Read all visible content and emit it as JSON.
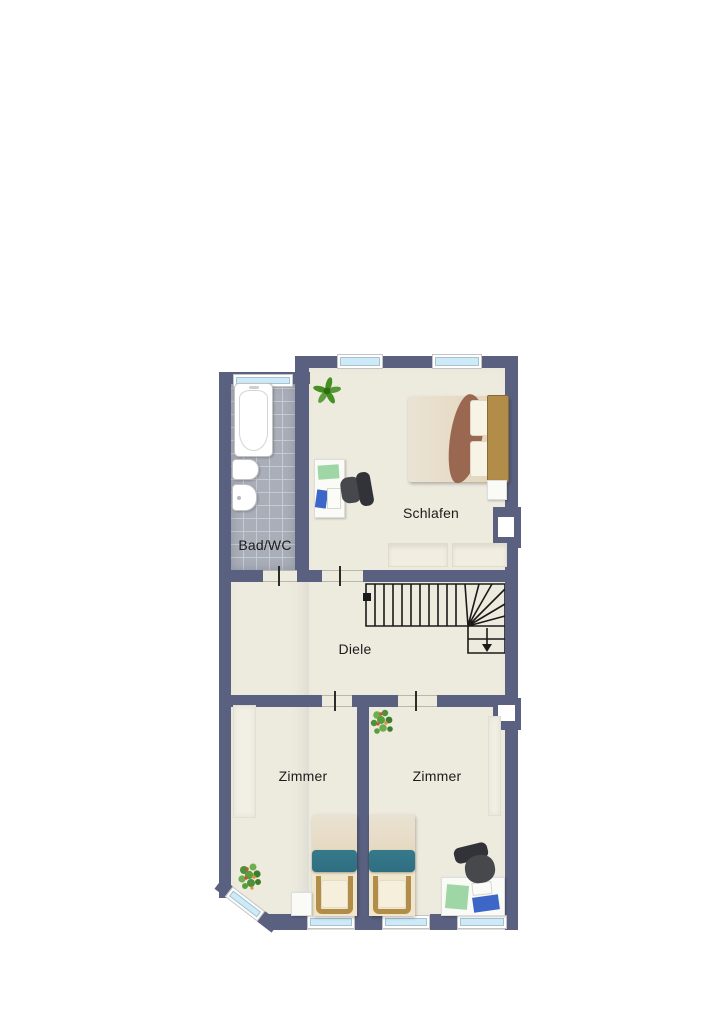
{
  "plan": {
    "type": "floor-plan",
    "rooms": {
      "bath": {
        "label": "Bad/WC"
      },
      "bedroom": {
        "label": "Schlafen"
      },
      "hall": {
        "label": "Diele"
      },
      "room_left": {
        "label": "Zimmer"
      },
      "room_right": {
        "label": "Zimmer"
      }
    },
    "colors": {
      "wall": "#596080",
      "floor": "#edeade",
      "tile": "#a9aeb8",
      "tile_line": "#c6cad2",
      "window_glass": "#cdeaf6",
      "window_frame": "#ffffff",
      "label_color": "#1c1c1c",
      "outline": "#1a1a1a",
      "bed_blanket": "#2e6e80",
      "throw": "#9a6850",
      "wood": "#b28c49",
      "wood_dark": "#8a6a33",
      "chair_dark": "#323338",
      "chair_mid": "#47484c",
      "desk_white": "#fafaf6",
      "desk_pad": "#9fd6a5",
      "paper_blue": "#3d66c9",
      "plant_green": "#449122",
      "flower_red": "#c5543c",
      "tub_white": "#ffffff"
    }
  }
}
